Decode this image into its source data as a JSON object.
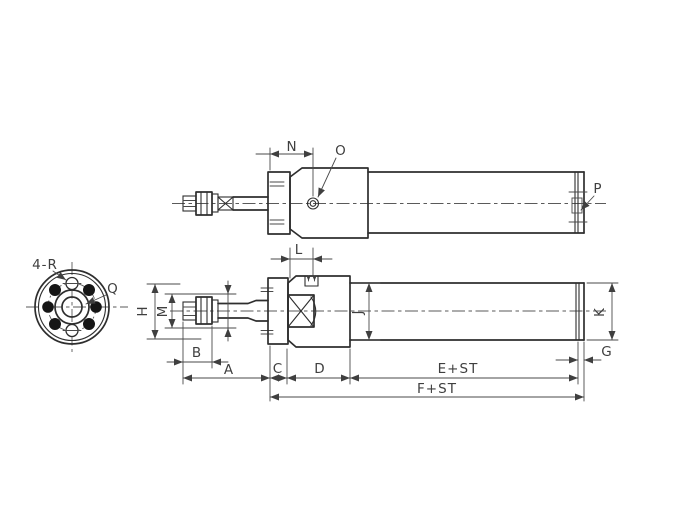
{
  "drawing": {
    "type": "pneumatic-cylinder-dimensional-drawing",
    "labels": {
      "end_view": {
        "corner_holes": "4-R",
        "port": "Q"
      },
      "top_view": {
        "n": "N",
        "o": "O",
        "p": "P"
      },
      "side_view": {
        "l": "L",
        "h": "H",
        "m": "M",
        "j": "J",
        "k": "K",
        "b": "B",
        "a": "A",
        "c": "C",
        "d": "D",
        "e_plus_stroke": "E+ST",
        "g": "G",
        "f_plus_stroke": "F+ST"
      }
    },
    "colors": {
      "background": "#ffffff",
      "object_line": "#2e2e2e",
      "dimension_line": "#4a4a4a",
      "label_text": "#3f3f3f"
    }
  }
}
